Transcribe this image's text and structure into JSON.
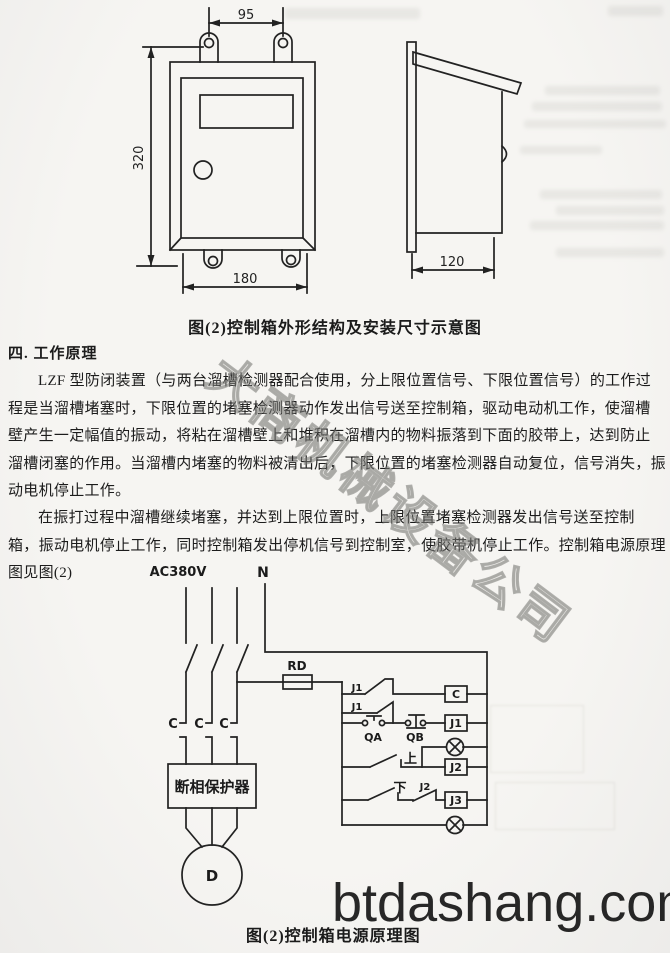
{
  "document": {
    "figure1_caption": "图(2)控制箱外形结构及安装尺寸示意图",
    "section_title": "四. 工作原理",
    "paragraph1_lines": [
      "LZF 型防闭装置（与两台溜槽检测器配合使用，分上限位置信号、下限位置信号）的工作过",
      "程是当溜槽堵塞时，下限位置的堵塞检测器动作发出信号送至控制箱，驱动电动机工作，使溜槽",
      "壁产生一定幅值的振动，将粘在溜槽壁上和堆积在溜槽内的物料振落到下面的胶带上，达到防止",
      "溜槽闭塞的作用。当溜槽内堵塞的物料被清出后，下限位置的堵塞检测器自动复位，信号消失，振",
      "动电机停止工作。"
    ],
    "paragraph2_lines": [
      "在振打过程中溜槽继续堵塞，并达到上限位置时，上限位置堵塞检测器发出信号送至控制",
      "箱，振动电机停止工作，同时控制箱发出停机信号到控制室，使胶带机停止工作。控制箱电源原理",
      "图见图(2)"
    ],
    "figure2_caption": "图(2)控制箱电源原理图",
    "site_watermark": "btdashang.com",
    "diagonal_watermark": "大商机械设备公司"
  },
  "figure1": {
    "dim_width_top": "95",
    "dim_height": "320",
    "dim_width_bottom": "180",
    "dim_depth": "120"
  },
  "circuit": {
    "supply_label": "AC380V",
    "neutral_label": "N",
    "fuse_label": "RD",
    "contact_j1_seal": "J1",
    "contact_j1_aux": "J1",
    "button_start": "QA",
    "button_stop": "QB",
    "contact_upper": "上",
    "contact_lower": "下",
    "contact_j2": "J2",
    "coil_contactor": "C",
    "coil_relay1": "J1",
    "coil_relay2": "J2",
    "coil_relay3": "J3",
    "phase_contact_1": "C",
    "phase_contact_2": "C",
    "phase_contact_3": "C",
    "phase_protector": "断相保护器",
    "motor_label": "D"
  }
}
